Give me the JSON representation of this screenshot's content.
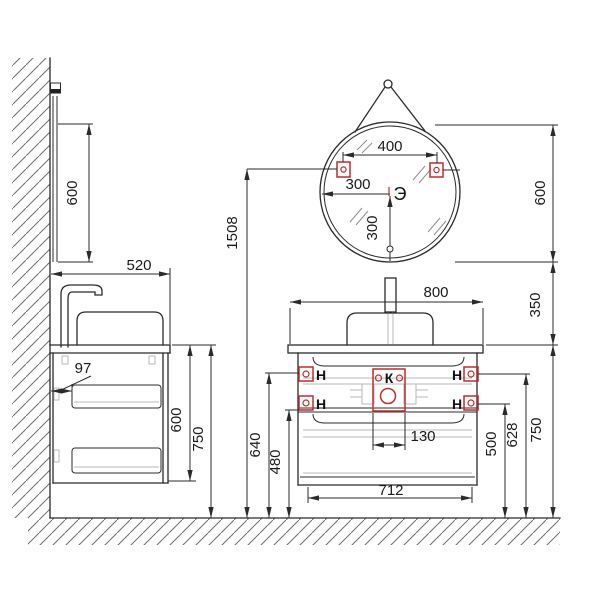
{
  "drawing": {
    "type": "bathroom vanity and round mirror installation dimensions",
    "units": "mm"
  },
  "colors": {
    "line": "#2b2b2b",
    "accent_red": "#c42b2b",
    "hardware_gray": "#b8b8b8",
    "background": "#ffffff"
  },
  "side_view": {
    "mirror_height": "600",
    "depth": "520",
    "wall_offset": "97",
    "cabinet_height": "600",
    "total_height": "750"
  },
  "mirror": {
    "mount_span": "400",
    "center_offset_left": "300",
    "center_offset_down": "300",
    "diameter": "600",
    "electric_point_label": "Э",
    "mount_height_above_floor": "1508",
    "gap_to_counter": "350"
  },
  "cabinet": {
    "width": "800",
    "counter_height_above_floor": "750",
    "inner_width": "712",
    "comm_box_width": "130",
    "upper_bracket_left_height": "640",
    "lower_bracket_left_height": "480",
    "upper_bracket_right_height": "628",
    "lower_bracket_right_height": "500",
    "hanger_label": "H",
    "comm_label": "К"
  }
}
